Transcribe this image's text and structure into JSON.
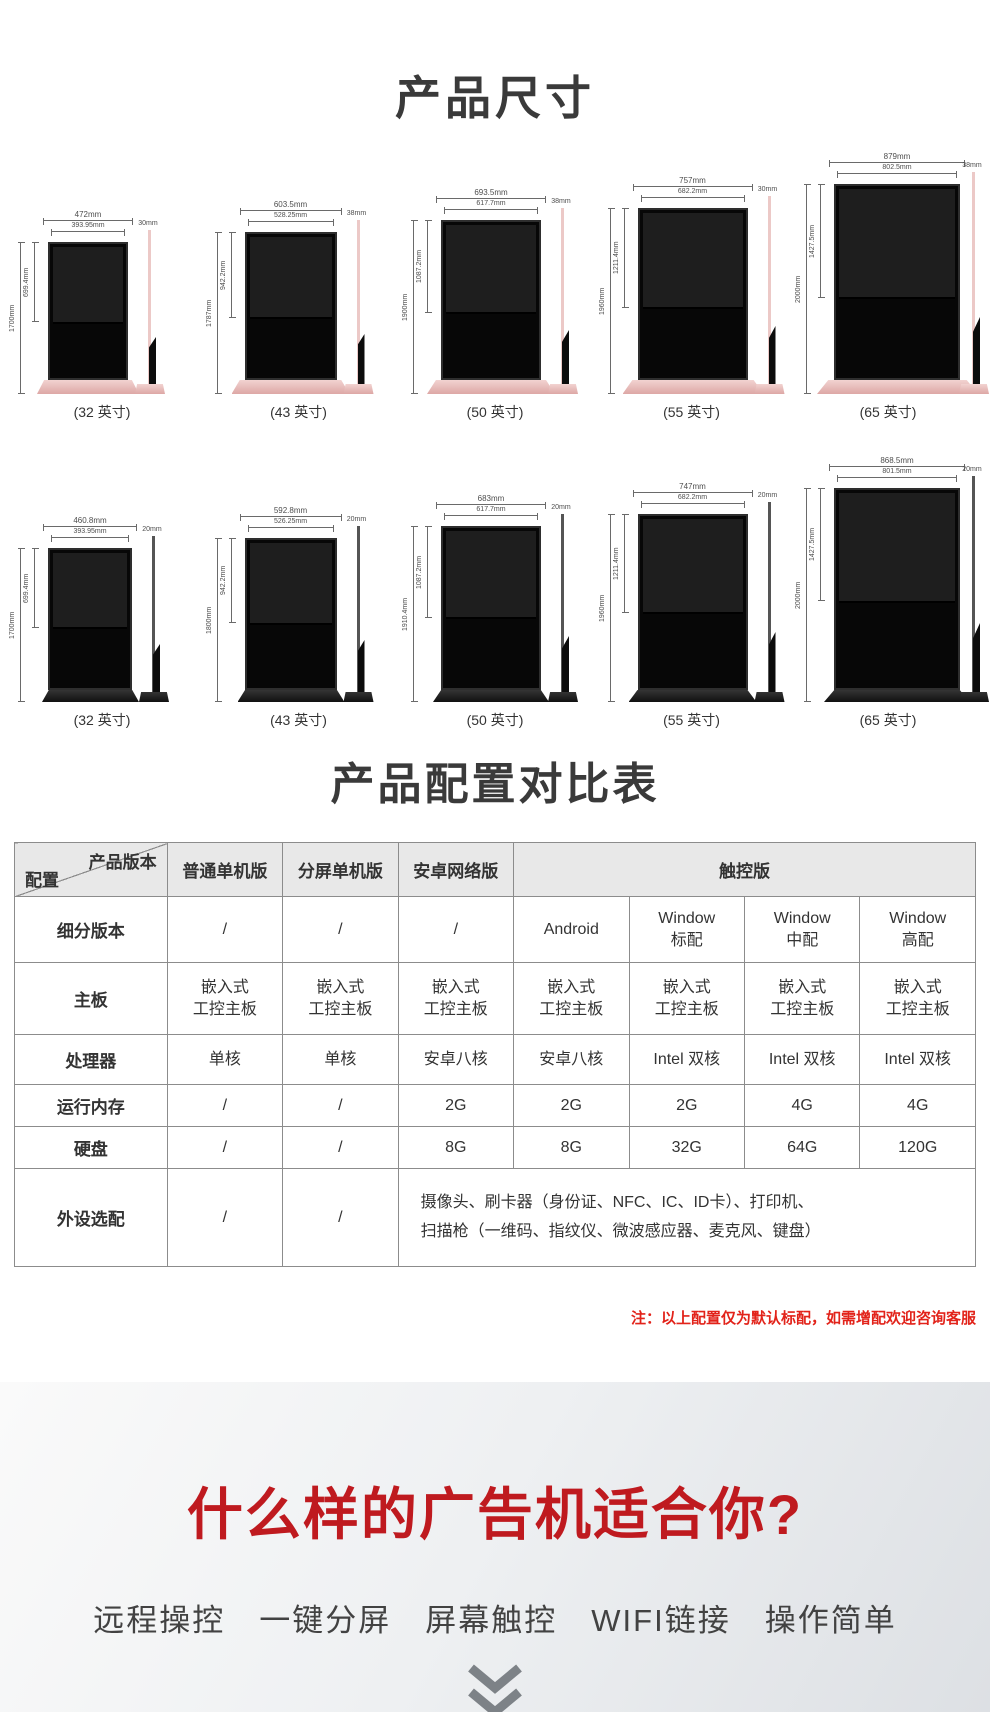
{
  "dimensions": {
    "title": "产品尺寸",
    "rows": [
      {
        "name": "front-view-row",
        "style": "pink",
        "items": [
          {
            "label": "(32 英寸)",
            "outer": "472mm",
            "inner": "393.95mm",
            "screen": "699.4mm",
            "total": "1700mm",
            "side": "30mm"
          },
          {
            "label": "(43 英寸)",
            "outer": "603.5mm",
            "inner": "528.25mm",
            "screen": "942.2mm",
            "total": "1787mm",
            "side": "38mm"
          },
          {
            "label": "(50 英寸)",
            "outer": "693.5mm",
            "inner": "617.7mm",
            "screen": "1087.2mm",
            "total": "1900mm",
            "side": "38mm"
          },
          {
            "label": "(55 英寸)",
            "outer": "757mm",
            "inner": "682.2mm",
            "screen": "1211.4mm",
            "total": "1960mm",
            "side": "30mm"
          },
          {
            "label": "(65 英寸)",
            "outer": "879mm",
            "inner": "802.5mm",
            "screen": "1427.5mm",
            "total": "2000mm",
            "side": "38mm"
          }
        ]
      },
      {
        "name": "rear-view-row",
        "style": "black",
        "items": [
          {
            "label": "(32 英寸)",
            "outer": "460.8mm",
            "inner": "393.95mm",
            "screen": "699.4mm",
            "total": "1700mm",
            "side": "20mm"
          },
          {
            "label": "(43 英寸)",
            "outer": "592.8mm",
            "inner": "526.25mm",
            "screen": "942.2mm",
            "total": "1800mm",
            "side": "20mm"
          },
          {
            "label": "(50 英寸)",
            "outer": "683mm",
            "inner": "617.7mm",
            "screen": "1087.2mm",
            "total": "1910.4mm",
            "side": "20mm"
          },
          {
            "label": "(55 英寸)",
            "outer": "747mm",
            "inner": "682.2mm",
            "screen": "1211.4mm",
            "total": "1960mm",
            "side": "20mm"
          },
          {
            "label": "(65 英寸)",
            "outer": "868.5mm",
            "inner": "801.5mm",
            "screen": "1427.5mm",
            "total": "2000mm",
            "side": "20mm"
          }
        ]
      }
    ]
  },
  "spec": {
    "title": "产品配置对比表",
    "table": {
      "corner": {
        "top": "产品版本",
        "bottom": "配置"
      },
      "columns": [
        "普通单机版",
        "分屏单机版",
        "安卓网络版"
      ],
      "touch_group": "触控版",
      "rows": [
        {
          "label": "细分版本",
          "values": [
            "/",
            "/",
            "/",
            "Android",
            "Window\n标配",
            "Window\n中配",
            "Window\n高配"
          ]
        },
        {
          "label": "主板",
          "values": [
            "嵌入式\n工控主板",
            "嵌入式\n工控主板",
            "嵌入式\n工控主板",
            "嵌入式\n工控主板",
            "嵌入式\n工控主板",
            "嵌入式\n工控主板",
            "嵌入式\n工控主板"
          ]
        },
        {
          "label": "处理器",
          "values": [
            "单核",
            "单核",
            "安卓八核",
            "安卓八核",
            "Intel 双核",
            "Intel 双核",
            "Intel 双核"
          ]
        },
        {
          "label": "运行内存",
          "values": [
            "/",
            "/",
            "2G",
            "2G",
            "2G",
            "4G",
            "4G"
          ]
        },
        {
          "label": "硬盘",
          "values": [
            "/",
            "/",
            "8G",
            "8G",
            "32G",
            "64G",
            "120G"
          ]
        },
        {
          "label": "外设选配",
          "values": [
            "/",
            "/"
          ],
          "merged": "摄像头、刷卡器（身份证、NFC、IC、ID卡）、打印机、\n扫描枪（一维码、指纹仪、微波感应器、麦克风、键盘）"
        }
      ]
    },
    "note": "注：以上配置仅为默认标配，如需增配欢迎咨询客服"
  },
  "promo": {
    "title": "什么样的广告机适合你?",
    "features": [
      "远程操控",
      "一键分屏",
      "屏幕触控",
      "WIFI链接",
      "操作简单"
    ],
    "icon": "double-chevron-down",
    "colors": {
      "title_red": "#bf1a1f",
      "note_red": "#e2231a",
      "chevron_gray": "#7d8287"
    }
  }
}
